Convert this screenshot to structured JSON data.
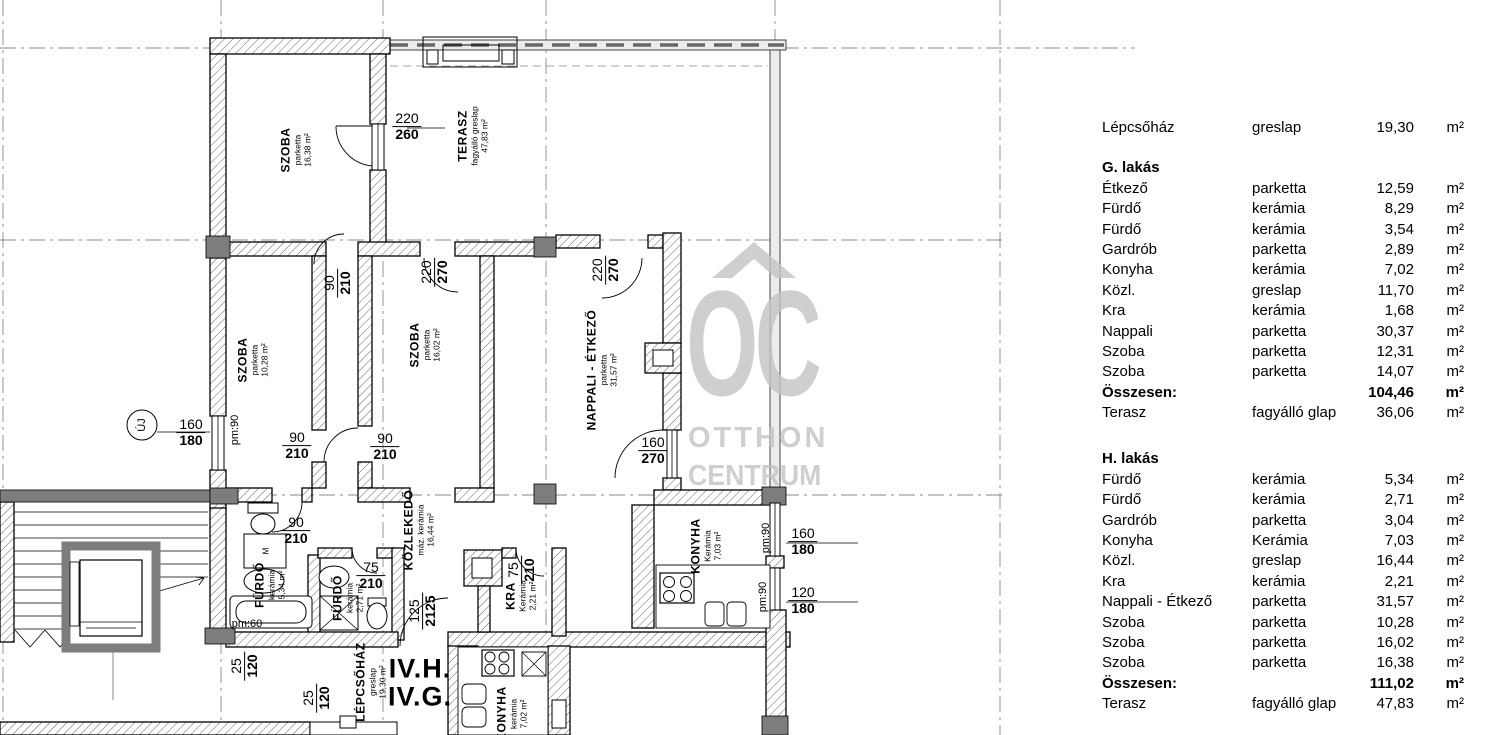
{
  "legend": {
    "intro": {
      "name": "Lépcsőház",
      "material": "greslap",
      "area": "19,30",
      "unit": "m²"
    },
    "sections": [
      {
        "title": "G. lakás",
        "rows": [
          [
            "Étkező",
            "parketta",
            "12,59",
            "m²"
          ],
          [
            "Fürdő",
            "kerámia",
            "8,29",
            "m²"
          ],
          [
            "Fürdő",
            "kerámia",
            "3,54",
            "m²"
          ],
          [
            "Gardrób",
            "parketta",
            "2,89",
            "m²"
          ],
          [
            "Konyha",
            "kerámia",
            "7,02",
            "m²"
          ],
          [
            "Közl.",
            "greslap",
            "11,70",
            "m²"
          ],
          [
            "Kra",
            "kerámia",
            "1,68",
            "m²"
          ],
          [
            "Nappali",
            "parketta",
            "30,37",
            "m²"
          ],
          [
            "Szoba",
            "parketta",
            "12,31",
            "m²"
          ],
          [
            "Szoba",
            "parketta",
            "14,07",
            "m²"
          ]
        ],
        "total": [
          "Összesen:",
          "",
          "104,46",
          "m²"
        ],
        "terrace": [
          "Terasz",
          "fagyálló glap",
          "36,06",
          "m²"
        ]
      },
      {
        "title": "H. lakás",
        "rows": [
          [
            "Fürdő",
            "kerámia",
            "5,34",
            "m²"
          ],
          [
            "Fürdő",
            "kerámia",
            "2,71",
            "m²"
          ],
          [
            "Gardrób",
            "parketta",
            "3,04",
            "m²"
          ],
          [
            "Konyha",
            "Kerámia",
            "7,03",
            "m²"
          ],
          [
            "Közl.",
            "greslap",
            "16,44",
            "m²"
          ],
          [
            "Kra",
            "kerámia",
            "2,21",
            "m²"
          ],
          [
            "Nappali - Étkező",
            "parketta",
            "31,57",
            "m²"
          ],
          [
            "Szoba",
            "parketta",
            "10,28",
            "m²"
          ],
          [
            "Szoba",
            "parketta",
            "16,02",
            "m²"
          ],
          [
            "Szoba",
            "parketta",
            "16,38",
            "m²"
          ]
        ],
        "total": [
          "Összesen:",
          "",
          "111,02",
          "m²"
        ],
        "terrace": [
          "Terasz",
          "fagyálló glap",
          "47,83",
          "m²"
        ]
      }
    ]
  },
  "plan": {
    "rooms": [
      {
        "name": "SZOBA",
        "material": "parketta",
        "area": "16,38 m²"
      },
      {
        "name": "TERASZ",
        "material": "fagyálló greslap",
        "area": "47,83 m²"
      },
      {
        "name": "SZOBA",
        "material": "parketta",
        "area": "10,28 m²"
      },
      {
        "name": "SZOBA",
        "material": "parketta",
        "area": "16,02 m²"
      },
      {
        "name": "NAPPALI - ÉTKEZŐ",
        "material": "parketta",
        "area": "31,57 m²"
      },
      {
        "name": "KÖZLEKEDŐ",
        "material": "máz. kerámia",
        "area": "16,44 m²"
      },
      {
        "name": "FÜRDŐ",
        "material": "kerámia",
        "area": "5,34 m²"
      },
      {
        "name": "FÜRDŐ",
        "material": "kerámia",
        "area": "2,71 m²"
      },
      {
        "name": "KRA",
        "material": "Kerámia",
        "area": "2,21 m²"
      },
      {
        "name": "KONYHA",
        "material": "Kerámia",
        "area": "7,03 m²"
      },
      {
        "name": "LÉPCSŐHÁZ",
        "material": "greslap",
        "area": "19,30 m²"
      },
      {
        "name": "KONYHA",
        "material": "kerámia",
        "area": "7,02 m²"
      }
    ],
    "dims": [
      {
        "a": "220",
        "b": "260"
      },
      {
        "a": "90",
        "b": "210"
      },
      {
        "a": "220",
        "b": "270"
      },
      {
        "a": "220",
        "b": "270"
      },
      {
        "a": "160",
        "b": "180"
      },
      {
        "a": "90",
        "b": "210"
      },
      {
        "a": "90",
        "b": "210"
      },
      {
        "a": "160",
        "b": "270"
      },
      {
        "a": "90",
        "b": "210"
      },
      {
        "a": "75",
        "b": "210"
      },
      {
        "a": "75",
        "b": "210"
      },
      {
        "a": "125",
        "b": "2125"
      },
      {
        "a": "25",
        "b": "120"
      },
      {
        "a": "25",
        "b": "120"
      },
      {
        "a": "160",
        "b": "180"
      },
      {
        "a": "120",
        "b": "180"
      }
    ],
    "pm_labels": [
      "pm:90",
      "pm:90",
      "pm:90",
      "pm:60"
    ],
    "marker": "ÚJ",
    "unit_labels": [
      "IV.H.",
      "IV.G."
    ],
    "fixture_labels": {
      "washing_machine": "M"
    },
    "watermark": {
      "oc": "OC",
      "line2": "OTTHON",
      "line3": "CENTRUM"
    }
  }
}
